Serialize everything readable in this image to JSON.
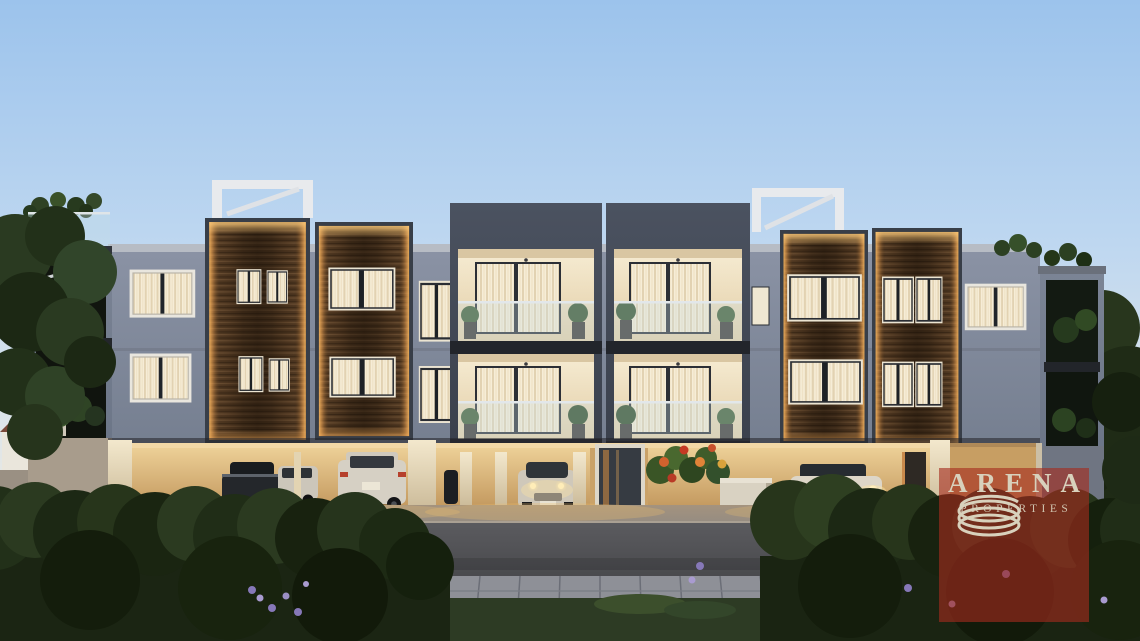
{
  "image": {
    "kind": "architectural dusk render",
    "subject": "three-storey modern apartment block with timber-clad facades, lit balconies, ground-floor parking with cars, landscaped street frontage at dusk"
  },
  "watermark": {
    "brand": "ARENA",
    "tagline": "PROPERTIES",
    "logo_icon": "spiral-rings-icon"
  },
  "colors": {
    "sky_top": "#9cc3ec",
    "sky_horizon": "#efeade",
    "facade_grey": "#7d8697",
    "frame_dark": "#454b57",
    "timber_brown": "#5d4329",
    "edge_glow": "#f0b873",
    "warm_interior": "#f3e7cc",
    "garage_glow": "#e2bc82",
    "foliage_dark": "#24301a",
    "road_grey": "#4e4f53",
    "watermark_overlay": "rgba(164,44,30,0.62)",
    "watermark_text": "#d8d1bc"
  }
}
